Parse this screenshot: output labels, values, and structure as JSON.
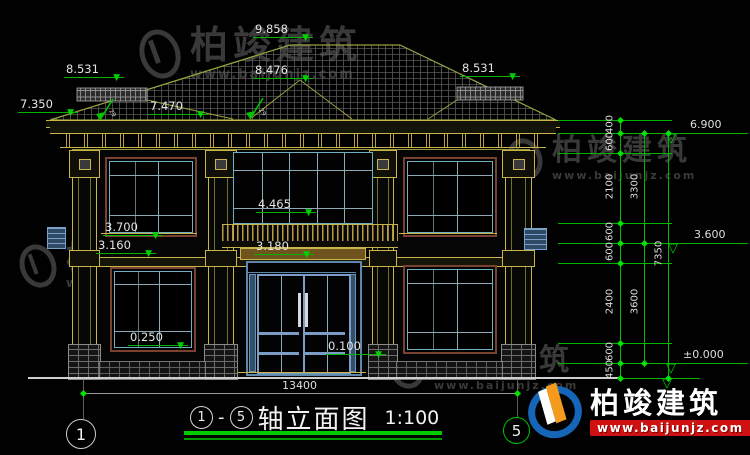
{
  "drawing": {
    "title": {
      "axis_start": "1",
      "sep": "-",
      "axis_end": "5",
      "name": "轴立面图",
      "scale": "1:100"
    },
    "axes": {
      "left": "1",
      "right": "5"
    },
    "overall_width": "13400",
    "slope_label": "29",
    "roof_marks": {
      "ridge": "9.858",
      "sub_ridge": "8.476",
      "side_ridge_left": "8.531",
      "side_ridge_right": "8.531",
      "roof_mid": "7.470",
      "eave_left": "7.350"
    },
    "facade_marks": {
      "central_window": "4.465",
      "left_window_sill": "3.700",
      "floor_band_left": "3.160",
      "entry_canopy": "3.180",
      "window_sill_1f": "0.250",
      "porch_level": "0.100"
    },
    "right_dims": {
      "segments": [
        "400",
        "600",
        "2100",
        "600",
        "600",
        "2400",
        "600",
        "450"
      ],
      "subtotals": [
        "3300",
        "3600"
      ],
      "total": "7350",
      "levels": [
        "6.900",
        "3.600",
        "±0.000"
      ]
    }
  },
  "watermark": {
    "brand": "柏竣建筑",
    "url": "www.baijunjz.com"
  },
  "icons": {
    "tri_solid": "▼",
    "tri_open": "▽"
  },
  "colors": {
    "annotation_green": "#00b400",
    "cad_yellow": "#c8b44a",
    "window_cyan": "#6fb0c0",
    "door_blue": "#7b9cc4",
    "logo_blue": "#1565b8",
    "logo_orange": "#f59a1d",
    "logo_red": "#d01111"
  }
}
